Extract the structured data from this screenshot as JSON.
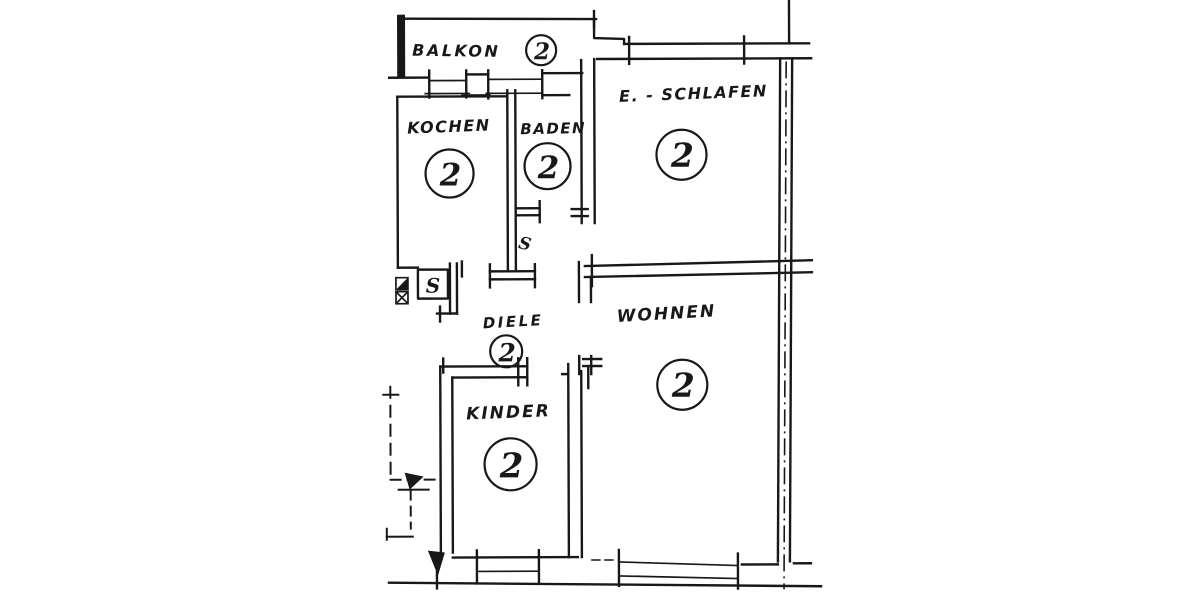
{
  "plan": {
    "rooms": [
      {
        "id": "balkon",
        "label": "BALKON",
        "number": "2"
      },
      {
        "id": "kochen",
        "label": "KOCHEN",
        "number": "2"
      },
      {
        "id": "baden",
        "label": "BADEN",
        "number": "2"
      },
      {
        "id": "schlafen",
        "label": "E. - SCHLAFEN",
        "number": "2"
      },
      {
        "id": "diele",
        "label": "DIELE",
        "number": "2"
      },
      {
        "id": "wohnen",
        "label": "WOHNEN",
        "number": "2"
      },
      {
        "id": "kinder",
        "label": "KINDER",
        "number": "2"
      }
    ],
    "annotations": [
      {
        "id": "shaft-box",
        "label": "S"
      },
      {
        "id": "wall-mark",
        "label": "S"
      }
    ]
  },
  "colors": {
    "ink": "#181818",
    "paper": "#ffffff"
  }
}
